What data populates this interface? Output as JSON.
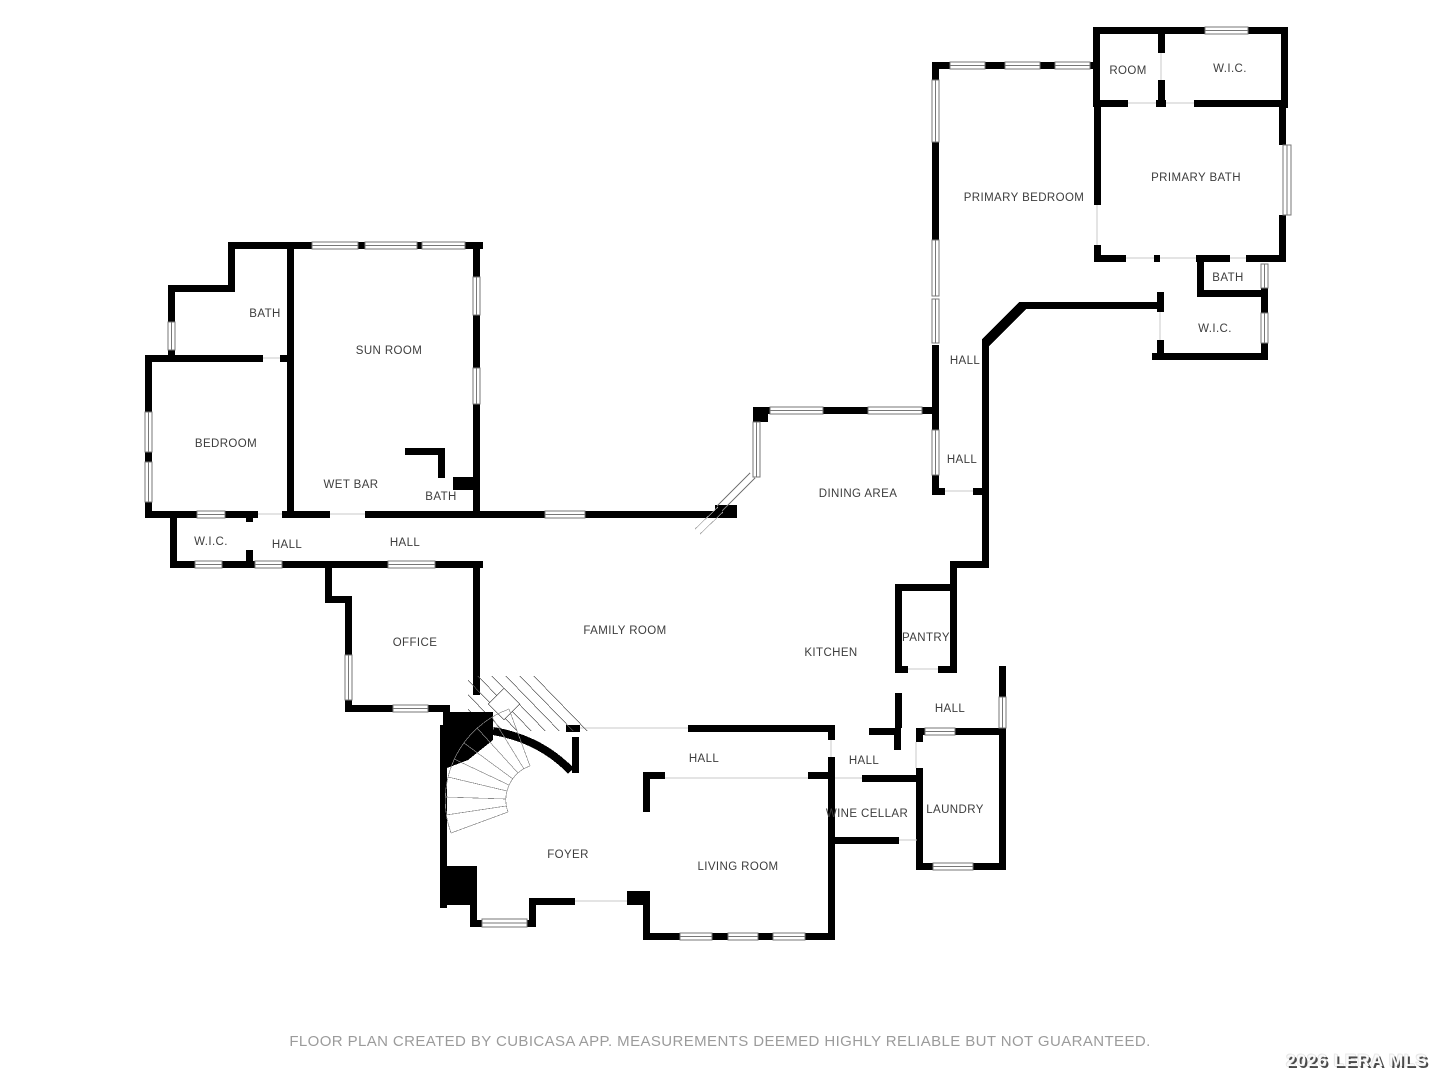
{
  "rooms": [
    {
      "label": "ROOM"
    },
    {
      "label": "W.I.C."
    },
    {
      "label": "PRIMARY BEDROOM"
    },
    {
      "label": "PRIMARY BATH"
    },
    {
      "label": "BATH"
    },
    {
      "label": "W.I.C."
    },
    {
      "label": "HALL"
    },
    {
      "label": "HALL"
    },
    {
      "label": "DINING AREA"
    },
    {
      "label": "BATH"
    },
    {
      "label": "SUN ROOM"
    },
    {
      "label": "BEDROOM"
    },
    {
      "label": "WET BAR"
    },
    {
      "label": "BATH"
    },
    {
      "label": "W.I.C."
    },
    {
      "label": "HALL"
    },
    {
      "label": "HALL"
    },
    {
      "label": "OFFICE"
    },
    {
      "label": "FAMILY ROOM"
    },
    {
      "label": "KITCHEN"
    },
    {
      "label": "PANTRY"
    },
    {
      "label": "HALL"
    },
    {
      "label": "HALL"
    },
    {
      "label": "HALL"
    },
    {
      "label": "WINE CELLAR"
    },
    {
      "label": "LAUNDRY"
    },
    {
      "label": "FOYER"
    },
    {
      "label": "LIVING ROOM"
    }
  ],
  "footer": {
    "text": "FLOOR PLAN CREATED BY CUBICASA APP. MEASUREMENTS DEEMED HIGHLY RELIABLE BUT NOT GUARANTEED."
  },
  "watermark": {
    "text": "2026 LERA MLS"
  },
  "colors": {
    "wall": "#000000",
    "footer_text": "#9b9b9b",
    "background": "#ffffff",
    "watermark_shadow": "#4a4a4a"
  }
}
